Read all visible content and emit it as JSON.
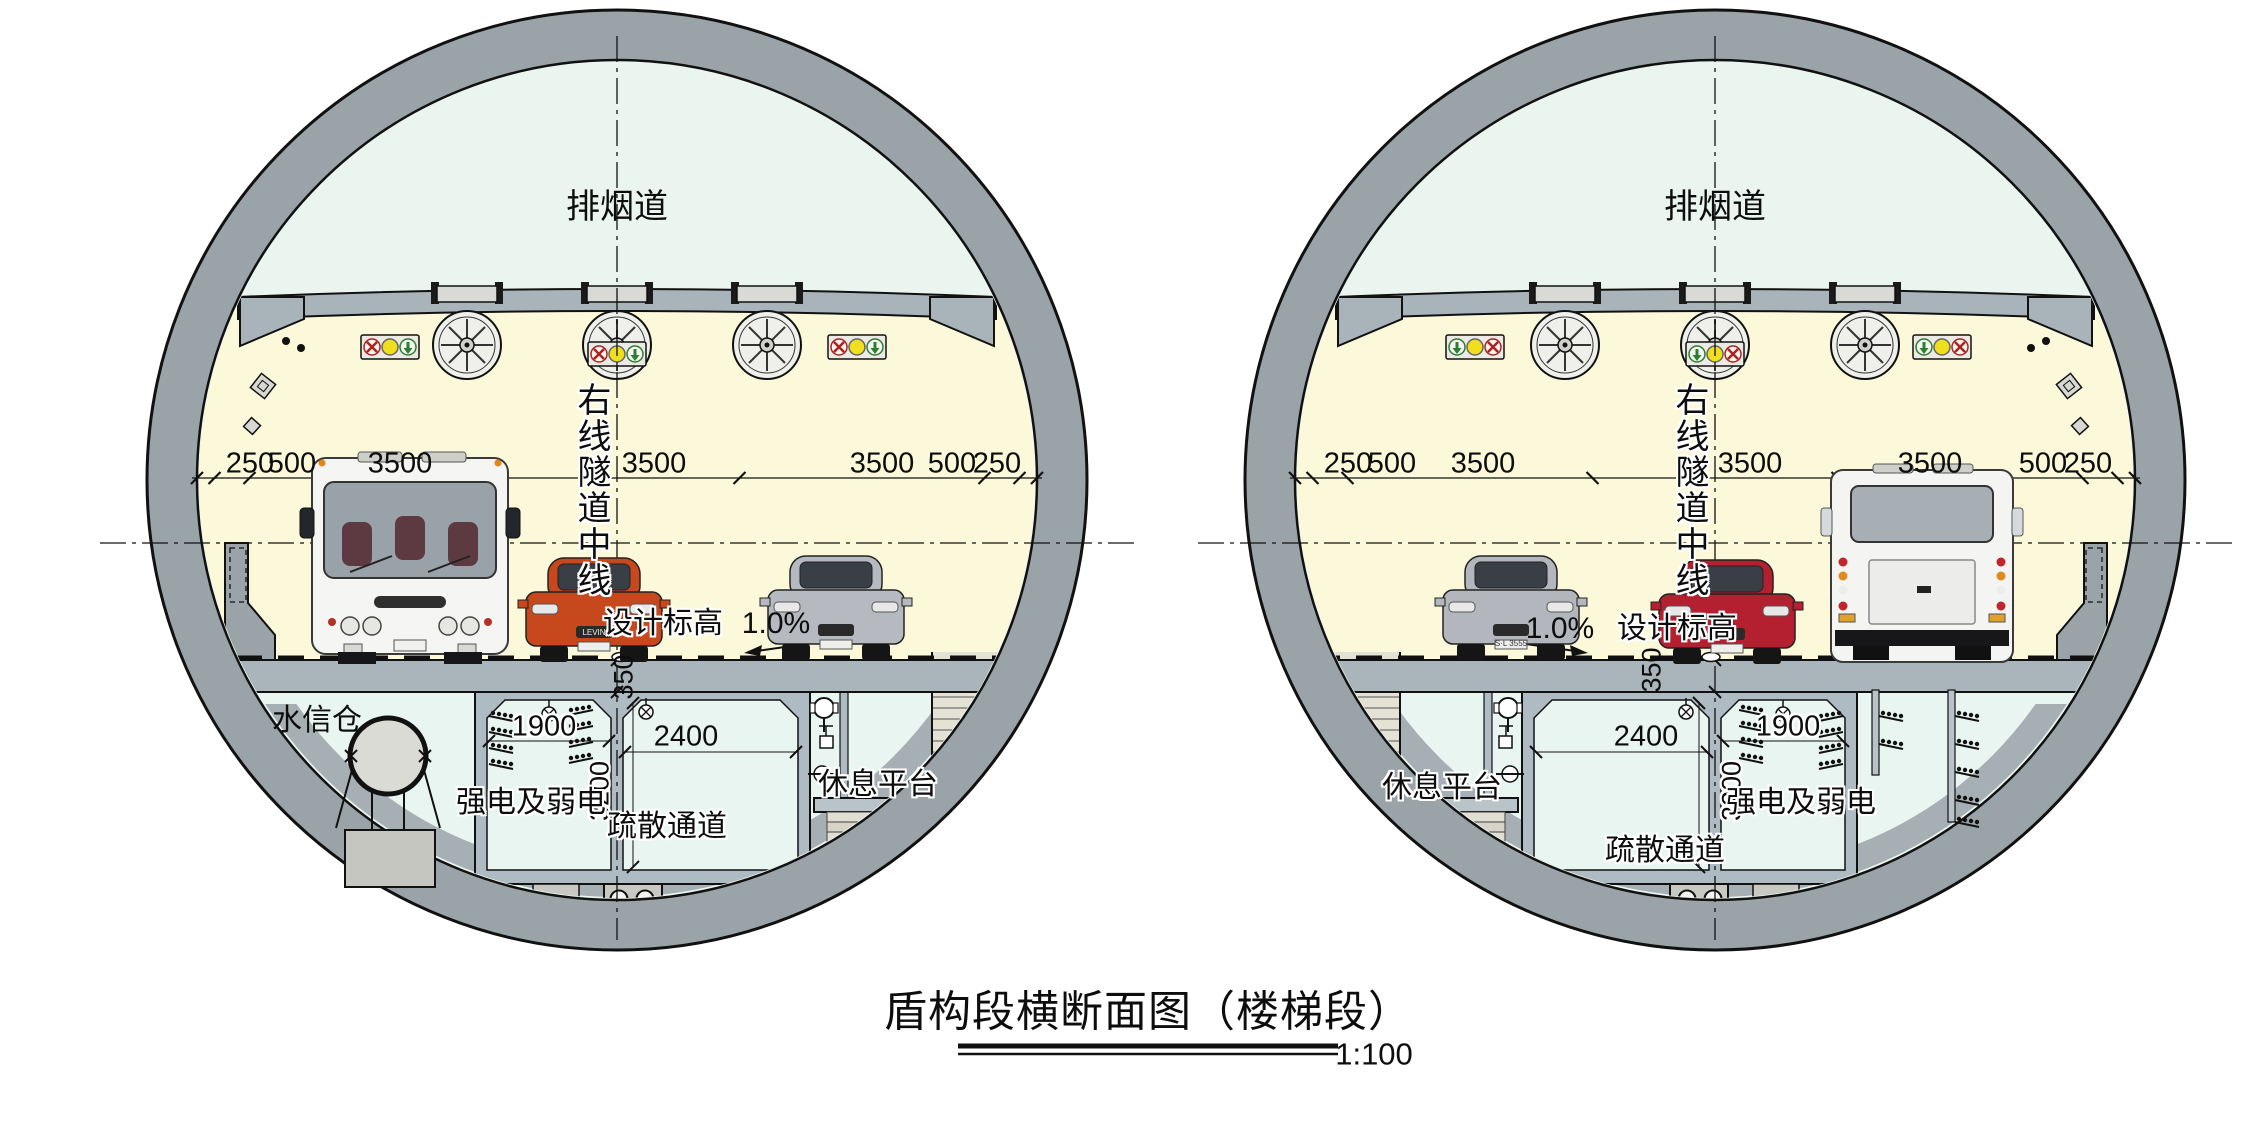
{
  "title": {
    "text": "盾构段横断面图（楼梯段）",
    "scale": "1:100"
  },
  "colors": {
    "lining_gray": "#9aa4a8",
    "smoke_duct_fill": "#eaf5f0",
    "roadway_fill": "#fcf9da",
    "compartment_fill": "#e9f5f1",
    "structure_gray": "#aebbc3",
    "signal_red": "#a82420",
    "signal_yellow": "#f0df1c",
    "signal_green": "#2e7d32",
    "car_orange": "#c8481e",
    "car_red": "#b52031",
    "car_silver": "#b6bac0"
  },
  "tunnels": [
    {
      "id": "left",
      "smoke_duct": "排烟道",
      "tunnel_centerline": "右线隧道中线",
      "design_elevation": "设计标高",
      "slope": "1.0%",
      "deck_dim": "350",
      "dims_top": [
        "250",
        "500",
        "3500",
        "3500",
        "3500",
        "500",
        "250"
      ],
      "water_signal_bay": "水信仓",
      "cable_bay_width": "1900",
      "passage_width": "2400",
      "passage_height": "3200",
      "power_label": "强电及弱电",
      "passage_label": "疏散通道",
      "platform_label": "休息平台",
      "car_badge": "LEVIN"
    },
    {
      "id": "right",
      "smoke_duct": "排烟道",
      "tunnel_centerline": "右线隧道中线",
      "design_elevation": "设计标高",
      "slope": "1.0%",
      "deck_dim": "350",
      "dims_top": [
        "250",
        "500",
        "3500",
        "3500",
        "3500",
        "500",
        "250"
      ],
      "cable_bay_width": "1900",
      "passage_width": "2400",
      "passage_height": "3200",
      "power_label": "强电及弱电",
      "passage_label": "疏散通道",
      "platform_label": "休息平台",
      "license_plate": "S·L 3555"
    }
  ]
}
